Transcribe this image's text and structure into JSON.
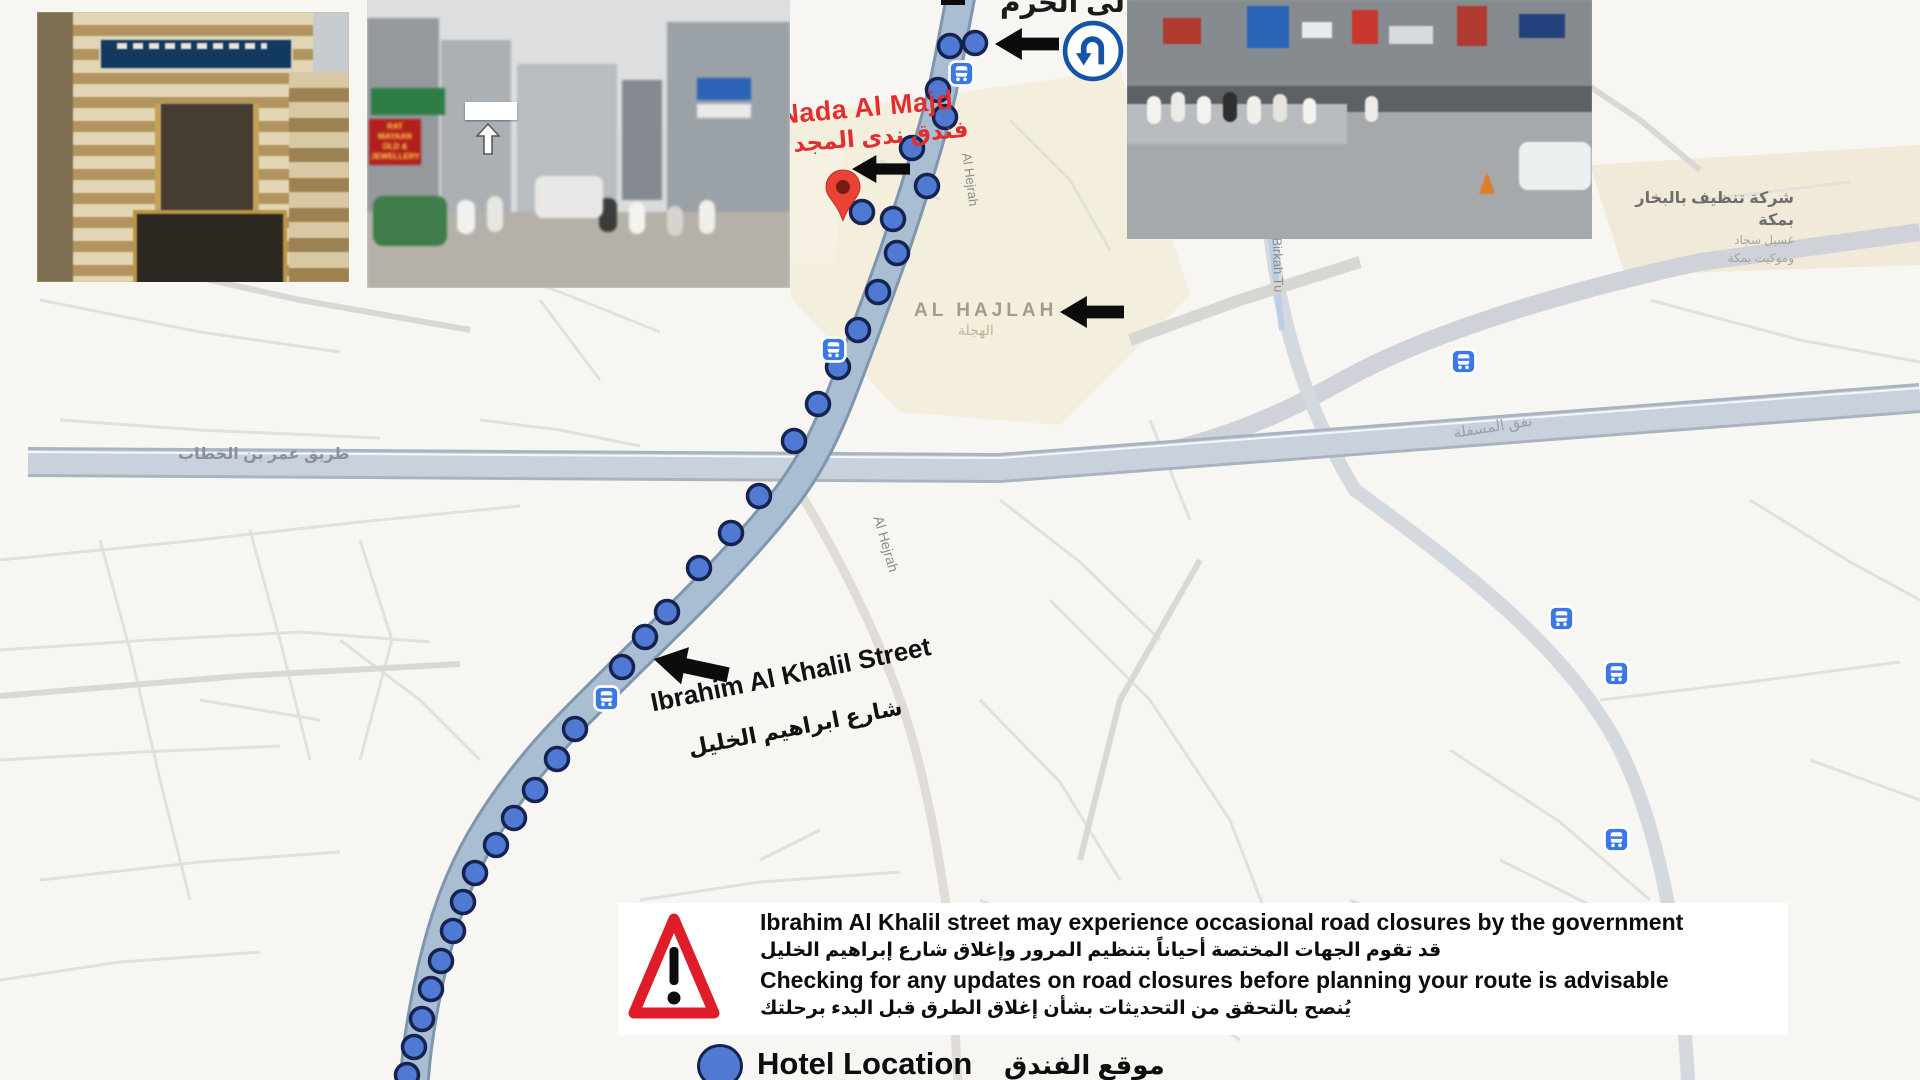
{
  "map": {
    "top_note_ar": "إلى الحرم",
    "hotel": {
      "name_en": "Nada Al Majd",
      "name_ar": "فندق ندى المجد"
    },
    "district": {
      "name_en": "AL HAJLAH",
      "name_ar": "الهجلة"
    },
    "street": {
      "name_en": "Ibrahim Al Khalil Street",
      "name_ar": "شارع ابراهيم الخليل"
    },
    "roads": {
      "omar_bin_khattab_ar": "طريق عمر بن الخطاب",
      "al_hejrah_upper": "Al Hejrah",
      "al_hejrah_lower": "Al Hejrah",
      "al_birkah": "Al Birkah Tu",
      "tunnel_ar": "نفق المسفلة"
    },
    "poi": {
      "line1_ar": "شركة تنظيف بالبخار بمكة",
      "line2_ar": "غسيل سجاد",
      "line3_ar": "وموكيت بمكة"
    }
  },
  "photo_b": {
    "sign_red_line1": "RAT MAYAAN",
    "sign_red_line2": "OLD & JEWELLERY"
  },
  "warning": {
    "line1_en": "Ibrahim Al Khalil street may experience occasional road closures by the government",
    "line1_ar": "قد تقوم الجهات المختصة أحياناً بتنظيم المرور وإغلاق شارع إبراهيم الخليل",
    "line2_en": "Checking for any updates on road closures before planning your route is advisable",
    "line2_ar": "يُنصح بالتحقق من التحديثات بشأن إغلاق الطرق قبل البدء برحلتك"
  },
  "legend": {
    "label_en": "Hotel Location",
    "label_ar": "موقع الفندق"
  },
  "colors": {
    "route_dot": "#4f79d2",
    "route_band": "#a9bdd3",
    "pin_red": "#ea4335",
    "hotel_label_red": "#e12f2f",
    "warning_red": "#df1d28",
    "bus_icon_blue": "#3b78e7"
  }
}
